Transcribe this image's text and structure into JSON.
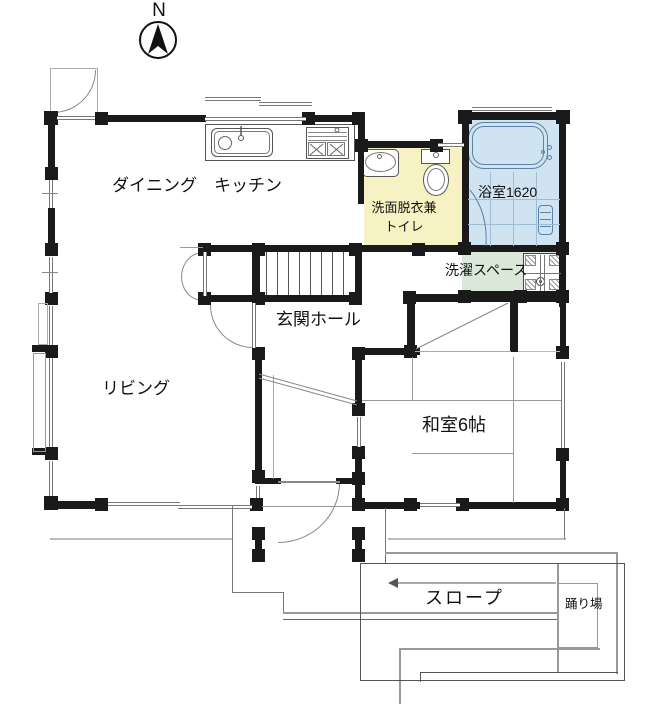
{
  "compass": {
    "label": "N"
  },
  "labels": {
    "dining_kitchen": "ダイニング　キッチン",
    "washroom_line1": "洗面脱衣兼",
    "washroom_line2": "トイレ",
    "bathroom": "浴室1620",
    "laundry": "洗濯スペース",
    "hall": "玄関ホール",
    "living": "リビング",
    "japanese_room": "和室6帖",
    "ramp": "スロープ",
    "landing": "踊り場"
  },
  "colors": {
    "wall": "#1a1a1a",
    "washroom_fill": "#f6f2c3",
    "bathroom_fill": "#cfe3f1",
    "laundry_fill": "#dae8da",
    "bath_stroke": "#5b82a6",
    "line_gray": "#999999"
  }
}
